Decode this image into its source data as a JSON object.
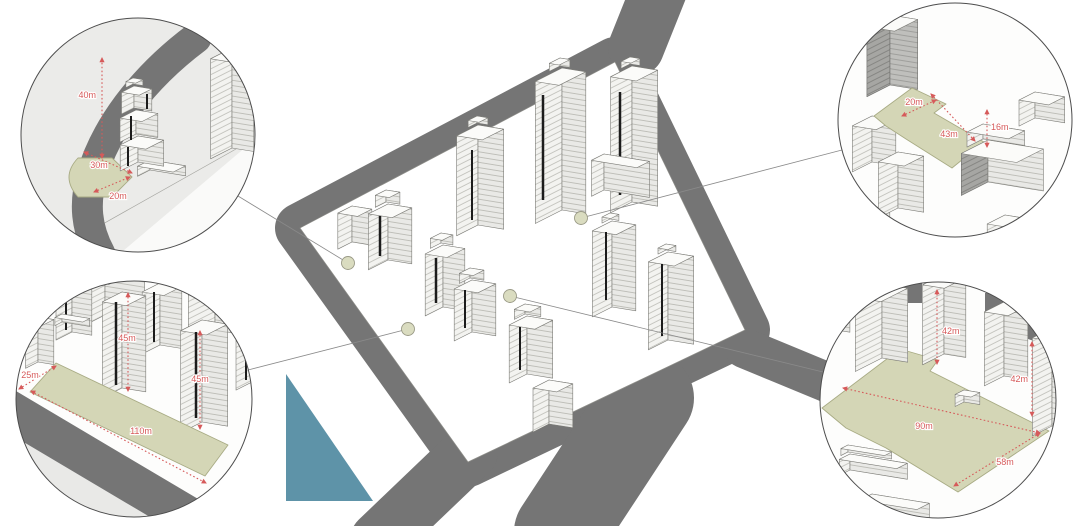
{
  "diagram": {
    "type": "urban-block-massing-axonometric",
    "callout_count": 4,
    "site_marker_count": 4
  },
  "colors": {
    "road": "#757575",
    "water": "#5E93A8",
    "plaza": "#D4D6B6",
    "plaza_border": "#A8AB84",
    "dimension": "#D65A5A",
    "marker_fill": "#DADCC0",
    "marker_border": "#9A9A86",
    "leader": "#8A8A8A",
    "circle_border": "#4D4D4D"
  },
  "callouts": {
    "top_left": {
      "dims": {
        "height": "40m",
        "depth": "30m",
        "width": "20m"
      }
    },
    "top_right": {
      "dims": {
        "width": "20m",
        "length": "43m",
        "height": "16m"
      }
    },
    "bottom_left": {
      "dims": {
        "width": "25m",
        "tower_height_1": "45m",
        "tower_height_2": "45m",
        "length": "110m"
      }
    },
    "bottom_right": {
      "dims": {
        "tower_height_1": "42m",
        "tower_height_2": "42m",
        "length": "90m",
        "width": "58m"
      }
    }
  }
}
